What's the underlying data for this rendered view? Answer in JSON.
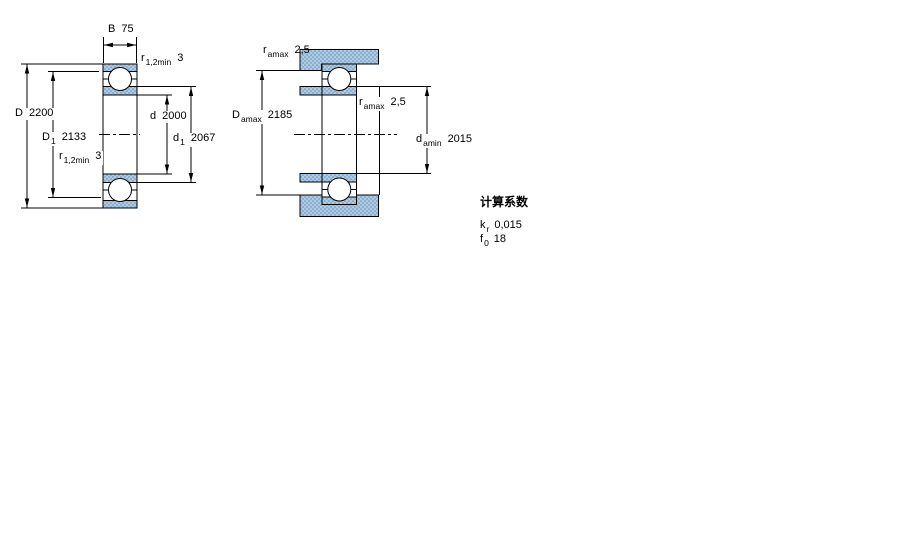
{
  "window": {
    "width": 900,
    "height": 560,
    "background": "#ffffff"
  },
  "colors": {
    "line": "#000000",
    "hatch_light": "#aecbe4",
    "hatch_dark": "#8eb0cf",
    "ball_fill": "#ffffff"
  },
  "left_figure": {
    "description": "bearing cross-section with boundary dimensions",
    "labels": {
      "B": {
        "main": "B",
        "value": "75"
      },
      "r_top": {
        "main": "r",
        "sub": "1,2min",
        "value": "3"
      },
      "D": {
        "main": "D",
        "value": "2200"
      },
      "D1": {
        "main": "D",
        "sub": "1",
        "value": "2133"
      },
      "r_bottom": {
        "main": "r",
        "sub": "1,2min",
        "value": "3"
      },
      "d": {
        "main": "d",
        "value": "2000"
      },
      "d1": {
        "main": "d",
        "sub": "1",
        "value": "2067"
      }
    }
  },
  "right_figure": {
    "description": "bearing mounted on shaft and housing with abutment dimensions",
    "labels": {
      "ra_top": {
        "main": "r",
        "sub": "amax",
        "value": "2,5"
      },
      "Da": {
        "main": "D",
        "sub": "amax",
        "value": "2185"
      },
      "ra_mid": {
        "main": "r",
        "sub": "amax",
        "value": "2,5"
      },
      "da": {
        "main": "d",
        "sub": "amin",
        "value": "2015"
      }
    }
  },
  "calculation_factors": {
    "heading": "计算系数",
    "rows": [
      {
        "main": "k",
        "sub": "r",
        "value": "0,015"
      },
      {
        "main": "f",
        "sub": "0",
        "value": "18"
      }
    ]
  }
}
